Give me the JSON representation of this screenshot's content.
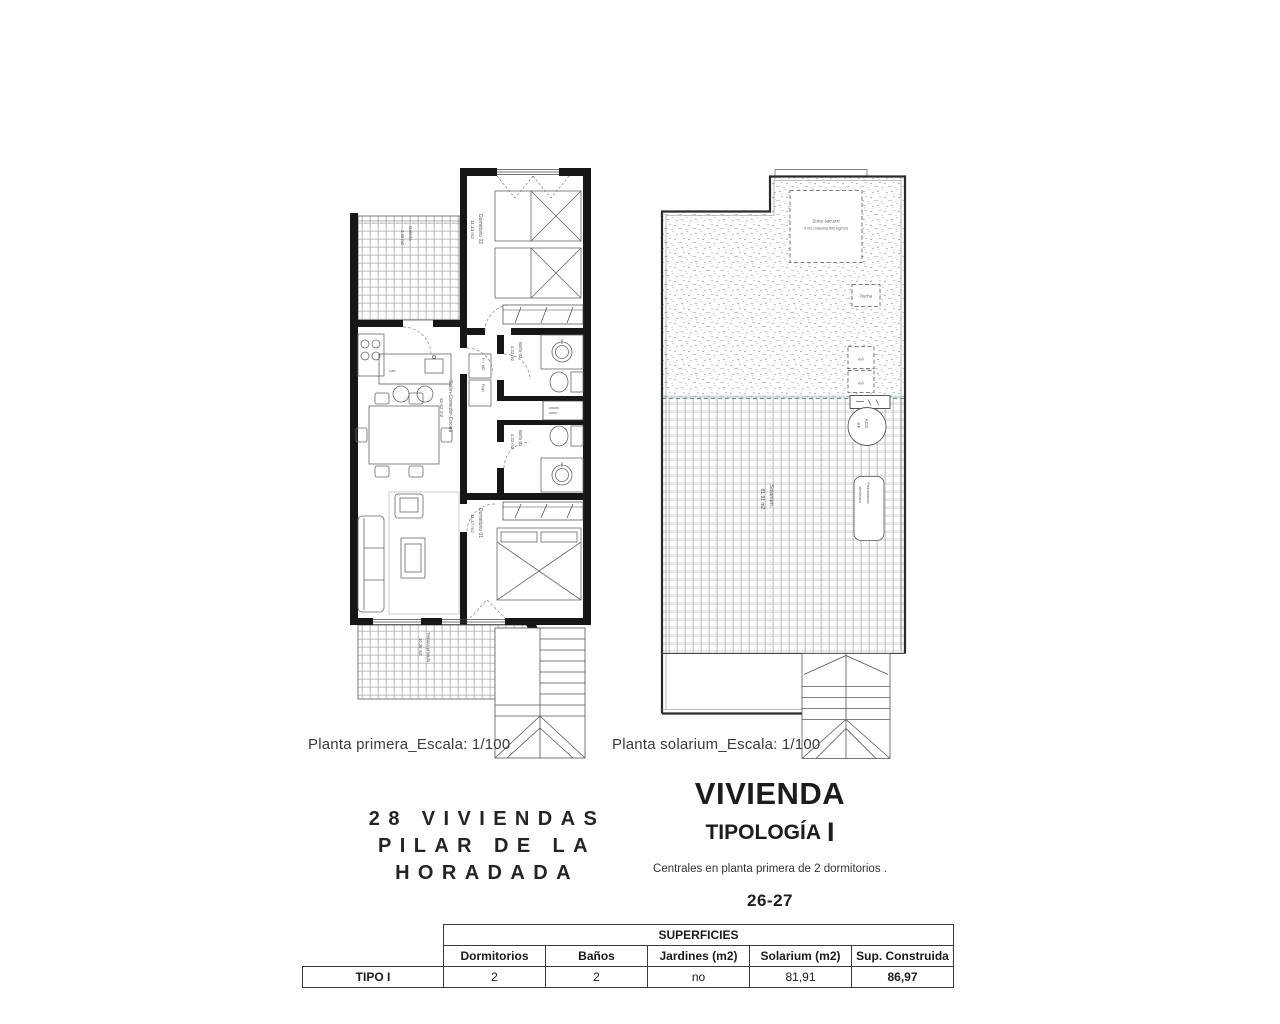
{
  "page": {
    "background": "#ffffff"
  },
  "captions": {
    "first_floor": "Planta primera_Escala: 1/100",
    "solarium": "Planta solarium_Escala: 1/100"
  },
  "project_title": {
    "line1": "28 VIVIENDAS",
    "line2": "PILAR DE LA",
    "line3": "HORADADA"
  },
  "typology": {
    "title": "VIVIENDA",
    "subtitle": "TIPOLOGÍA",
    "subtitle_letter": "I",
    "description": "Centrales en planta primera de 2 dormitorios .",
    "units": "26-27"
  },
  "surfaces_table": {
    "title": "SUPERFICIES",
    "row_label": "TIPO I",
    "columns": [
      "Dormitorios",
      "Baños",
      "Jardines (m2)",
      "Solarium (m2)",
      "Sup. Construida"
    ],
    "values": [
      "2",
      "2",
      "no",
      "81,91",
      "86,97"
    ]
  },
  "first_floor_plan": {
    "galeria": {
      "name": "Galería",
      "area": "3,40 m2"
    },
    "dormitorio_02": {
      "name": "Dormitorio 02",
      "area": "11,13 m2"
    },
    "bano_02": {
      "name": "Baño 02",
      "area": "4,22 m2"
    },
    "bano_01": {
      "name": "Baño 01",
      "area": "4,22 m2"
    },
    "dormitorio_01": {
      "name": "Dormitorio 01",
      "area": "11,17 m2"
    },
    "salon": {
      "name": "Salón-Comedor-Cocina",
      "area": "32,62 m2"
    },
    "terraza": {
      "name": "Terraza privada",
      "area": "10,28 m2"
    },
    "kitchen": {
      "oven": "H + MO",
      "fridge": "Frigo",
      "sink": "Lav"
    }
  },
  "solarium_plan": {
    "jacuzzi": {
      "name": "Zona Jacuzzi",
      "note": "4 m2 (máximo 500 kg/m2)"
    },
    "ducha": "Ducha",
    "aa_1": "AA",
    "aa_2": "AA",
    "acs": {
      "line1": "ACS",
      "line2": "AF"
    },
    "preinstalacion": {
      "line1": "Preinstalación",
      "line2": "aerotermia"
    },
    "solarium": {
      "name": "Solarium",
      "area": "81,91 m2"
    }
  }
}
